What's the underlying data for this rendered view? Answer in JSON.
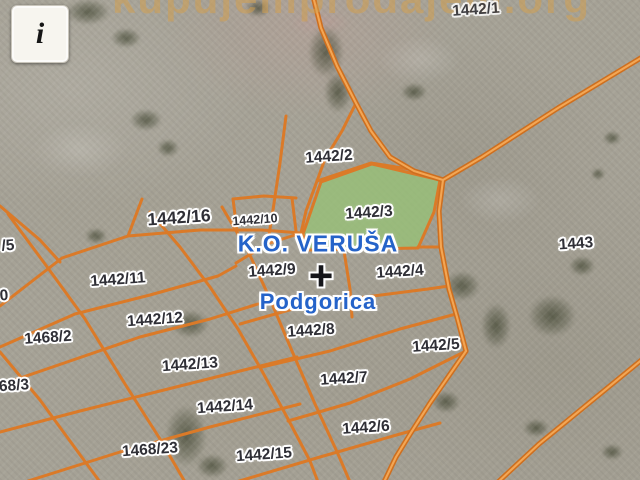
{
  "window": {
    "info_button_label": "i"
  },
  "watermark": {
    "text": "kupujemprodajem.org"
  },
  "map": {
    "area_label": {
      "cadastral_municipality": "K.O. VERUŠA",
      "municipality": "Podgorica"
    },
    "crosshair_symbol": "+",
    "highlighted_parcel": "1442/3",
    "colors": {
      "boundary": "#DB7A28",
      "road_base": "#CE6F1F",
      "road_core": "#F3A654",
      "highlight_fill": "#97C177",
      "label_text": "#2F2F36",
      "area_label_text": "#2563C9",
      "watermark": "#D2A051",
      "bg": "#A6A296"
    },
    "parcel_labels": [
      {
        "id": "1442/1",
        "x": 476,
        "y": 10,
        "size": "md",
        "faint": true
      },
      {
        "id": "1442/2",
        "x": 329,
        "y": 157,
        "size": "md"
      },
      {
        "id": "1442/3",
        "x": 369,
        "y": 213,
        "size": "md"
      },
      {
        "id": "1442/16",
        "x": 179,
        "y": 218,
        "size": "lg"
      },
      {
        "id": "1442/10",
        "x": 255,
        "y": 220,
        "size": "sm"
      },
      {
        "id": "/5",
        "x": 8,
        "y": 246,
        "size": "md"
      },
      {
        "id": "1443",
        "x": 576,
        "y": 244,
        "size": "md"
      },
      {
        "id": "1442/9",
        "x": 272,
        "y": 271,
        "size": "md"
      },
      {
        "id": "1442/4",
        "x": 400,
        "y": 272,
        "size": "md"
      },
      {
        "id": "1442/11",
        "x": 118,
        "y": 280,
        "size": "md"
      },
      {
        "id": "0",
        "x": 4,
        "y": 296,
        "size": "md"
      },
      {
        "id": "1442/12",
        "x": 155,
        "y": 320,
        "size": "md"
      },
      {
        "id": "1442/8",
        "x": 311,
        "y": 331,
        "size": "md"
      },
      {
        "id": "1468/2",
        "x": 48,
        "y": 338,
        "size": "md"
      },
      {
        "id": "1442/5",
        "x": 436,
        "y": 346,
        "size": "md"
      },
      {
        "id": "1442/13",
        "x": 190,
        "y": 365,
        "size": "md"
      },
      {
        "id": "1442/7",
        "x": 344,
        "y": 379,
        "size": "md"
      },
      {
        "id": "68/3",
        "x": 14,
        "y": 386,
        "size": "md"
      },
      {
        "id": "1442/14",
        "x": 225,
        "y": 407,
        "size": "md"
      },
      {
        "id": "1442/6",
        "x": 366,
        "y": 428,
        "size": "md"
      },
      {
        "id": "1468/23",
        "x": 150,
        "y": 450,
        "size": "md"
      },
      {
        "id": "1442/15",
        "x": 264,
        "y": 455,
        "size": "md"
      }
    ]
  }
}
